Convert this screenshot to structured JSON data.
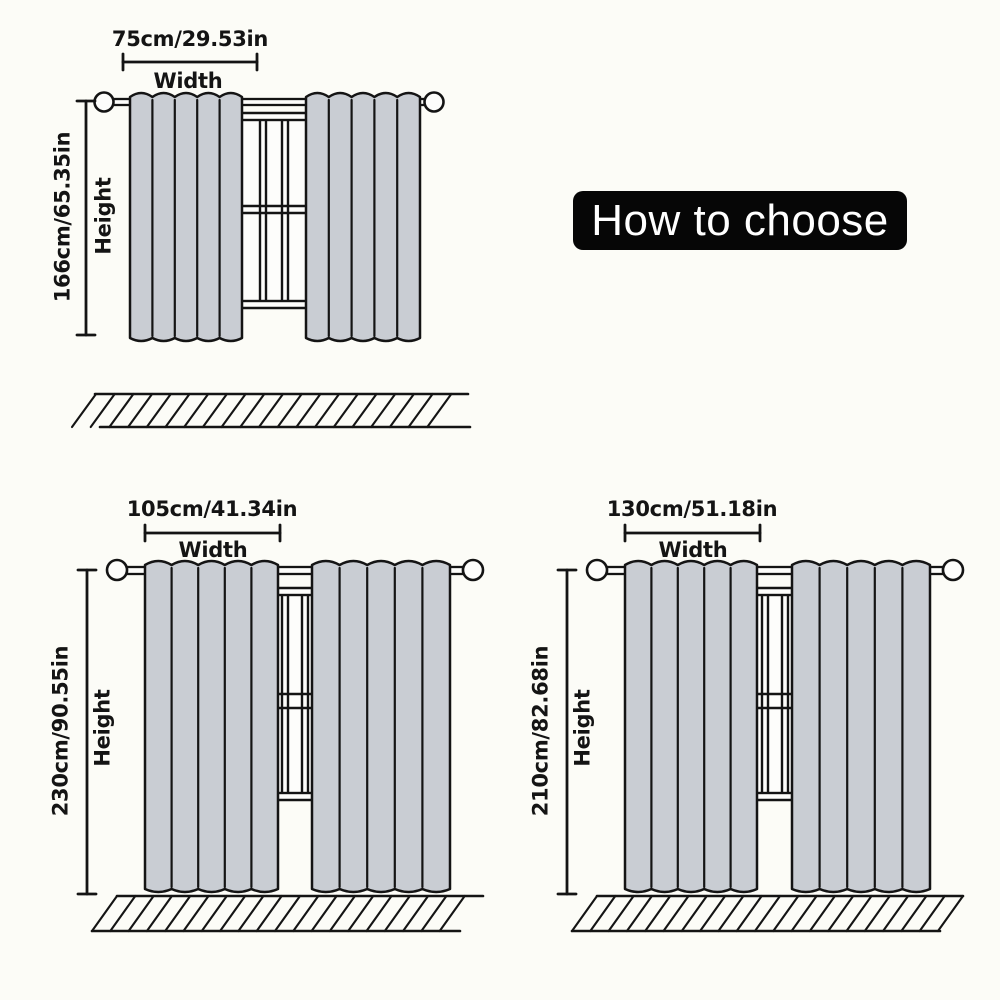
{
  "banner": {
    "label": "How to choose"
  },
  "colors": {
    "background": "#fcfcf7",
    "curtain_fill": "#c9cdd3",
    "line": "#141414",
    "surface_white": "#fdfdfb",
    "banner_bg": "#060606",
    "banner_text": "#ffffff"
  },
  "diagrams": [
    {
      "name": "curtain-size-75x166",
      "width_label": "75cm/29.53in",
      "width_word": "Width",
      "height_label": "166cm/65.35in",
      "height_word": "Height",
      "width_cm": 75,
      "width_in": 29.53,
      "height_cm": 166,
      "height_in": 65.35,
      "curtain_style": "short-above-sill"
    },
    {
      "name": "curtain-size-105x230",
      "width_label": "105cm/41.34in",
      "width_word": "Width",
      "height_label": "230cm/90.55in",
      "height_word": "Height",
      "width_cm": 105,
      "width_in": 41.34,
      "height_cm": 230,
      "height_in": 90.55,
      "curtain_style": "floor-length"
    },
    {
      "name": "curtain-size-130x210",
      "width_label": "130cm/51.18in",
      "width_word": "Width",
      "height_label": "210cm/82.68in",
      "height_word": "Height",
      "width_cm": 130,
      "width_in": 51.18,
      "height_cm": 210,
      "height_in": 82.68,
      "curtain_style": "floor-length"
    }
  ]
}
